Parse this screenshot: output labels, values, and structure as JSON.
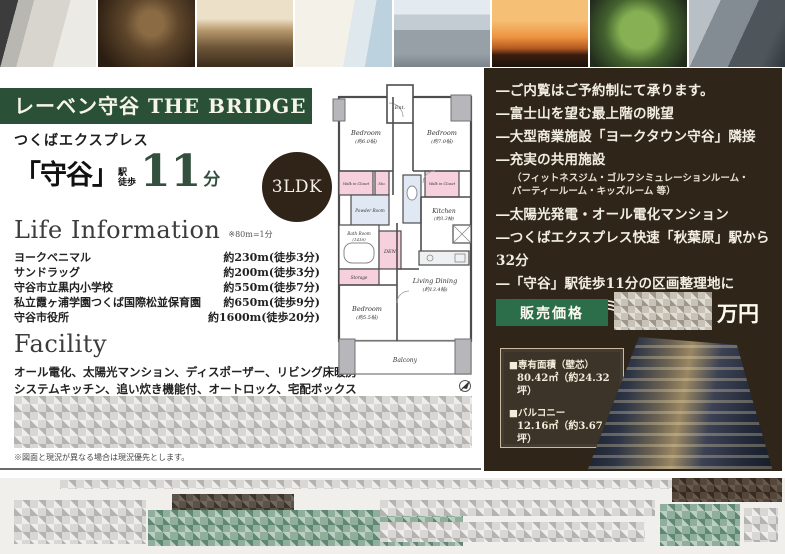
{
  "property": {
    "title": "レーベン守谷 THE BRIDGE",
    "layout_badge": "3LDK"
  },
  "access": {
    "line": "つくばエクスプレス",
    "station": "「守谷」",
    "label_station": "駅",
    "label_walk": "徒歩",
    "minutes": "11",
    "unit": "分"
  },
  "life_information": {
    "title": "Life Information",
    "note": "※80m=1分",
    "items": [
      {
        "name": "ヨークベニマル",
        "distance": "約230m(徒歩3分)"
      },
      {
        "name": "サンドラッグ",
        "distance": "約200m(徒歩3分)"
      },
      {
        "name": "守谷市立黒内小学校",
        "distance": "約550m(徒歩7分)"
      },
      {
        "name": "私立霞ヶ浦学園つくば国際松並保育園",
        "distance": "約650m(徒歩9分)"
      },
      {
        "name": "守谷市役所",
        "distance": "約1600m(徒歩20分)"
      }
    ]
  },
  "facility": {
    "title": "Facility",
    "line1": "オール電化、太陽光マンション、ディスポーザー、リビング床暖房",
    "line2": "システムキッチン、追い炊き機能付、オートロック、宅配ボックス"
  },
  "disclaimer": "※図面と現況が異なる場合は現況優先とします。",
  "features": {
    "item1": "―ご内覧はご予約制にて承ります。",
    "item2": "―富士山を望む最上階の眺望",
    "item3": "―大型商業施設「ヨークタウン守谷」隣接",
    "item4": "―充実の共用施設",
    "item4_note1": "（フィットネスジム・ゴルフシミュレーションルーム・",
    "item4_note2": "パーティールーム・キッズルーム 等）",
    "item5": "―太陽光発電・オール電化マンション",
    "item6": "―つくばエクスプレス快速「秋葉原」駅から32分",
    "item7": "―「守谷」駅徒歩11分の区画整理地に",
    "item7_line2": "広がるビッグコミュニティ"
  },
  "price": {
    "label": "販売価格",
    "unit": "万円"
  },
  "area_info": {
    "item1_label": "■専有面積（壁芯）",
    "item1_value": "80.42㎡（約24.32坪）",
    "item2_label": "■バルコニー",
    "item2_value": "12.16㎡（約3.67坪）"
  },
  "floor_plan": {
    "ent": "Ent.",
    "bedroom1": "Bedroom",
    "bedroom1_size": "(約6.0帖)",
    "bedroom2": "Bedroom",
    "bedroom2_size": "(約7.0帖)",
    "bedroom3": "Bedroom",
    "bedroom3_size": "(約5.5帖)",
    "walk_in_closet": "Walk in Closet",
    "powder_room": "Powder Room",
    "bath_room": "Bath Room",
    "bath_size": "(1418)",
    "den": "DEN",
    "sto": "Sto.",
    "storage": "Storage",
    "kitchen": "Kitchen",
    "kitchen_size": "(約3.3帖)",
    "living_dining": "Living Dining",
    "living_size": "(約13.4帖)",
    "balcony": "Balcony"
  },
  "colors": {
    "banner_green": "#2a5138",
    "panel_brown": "#2f2519",
    "price_green": "#2c6e4a",
    "badge_brown": "#302418",
    "accent_number_green": "#33503f"
  }
}
